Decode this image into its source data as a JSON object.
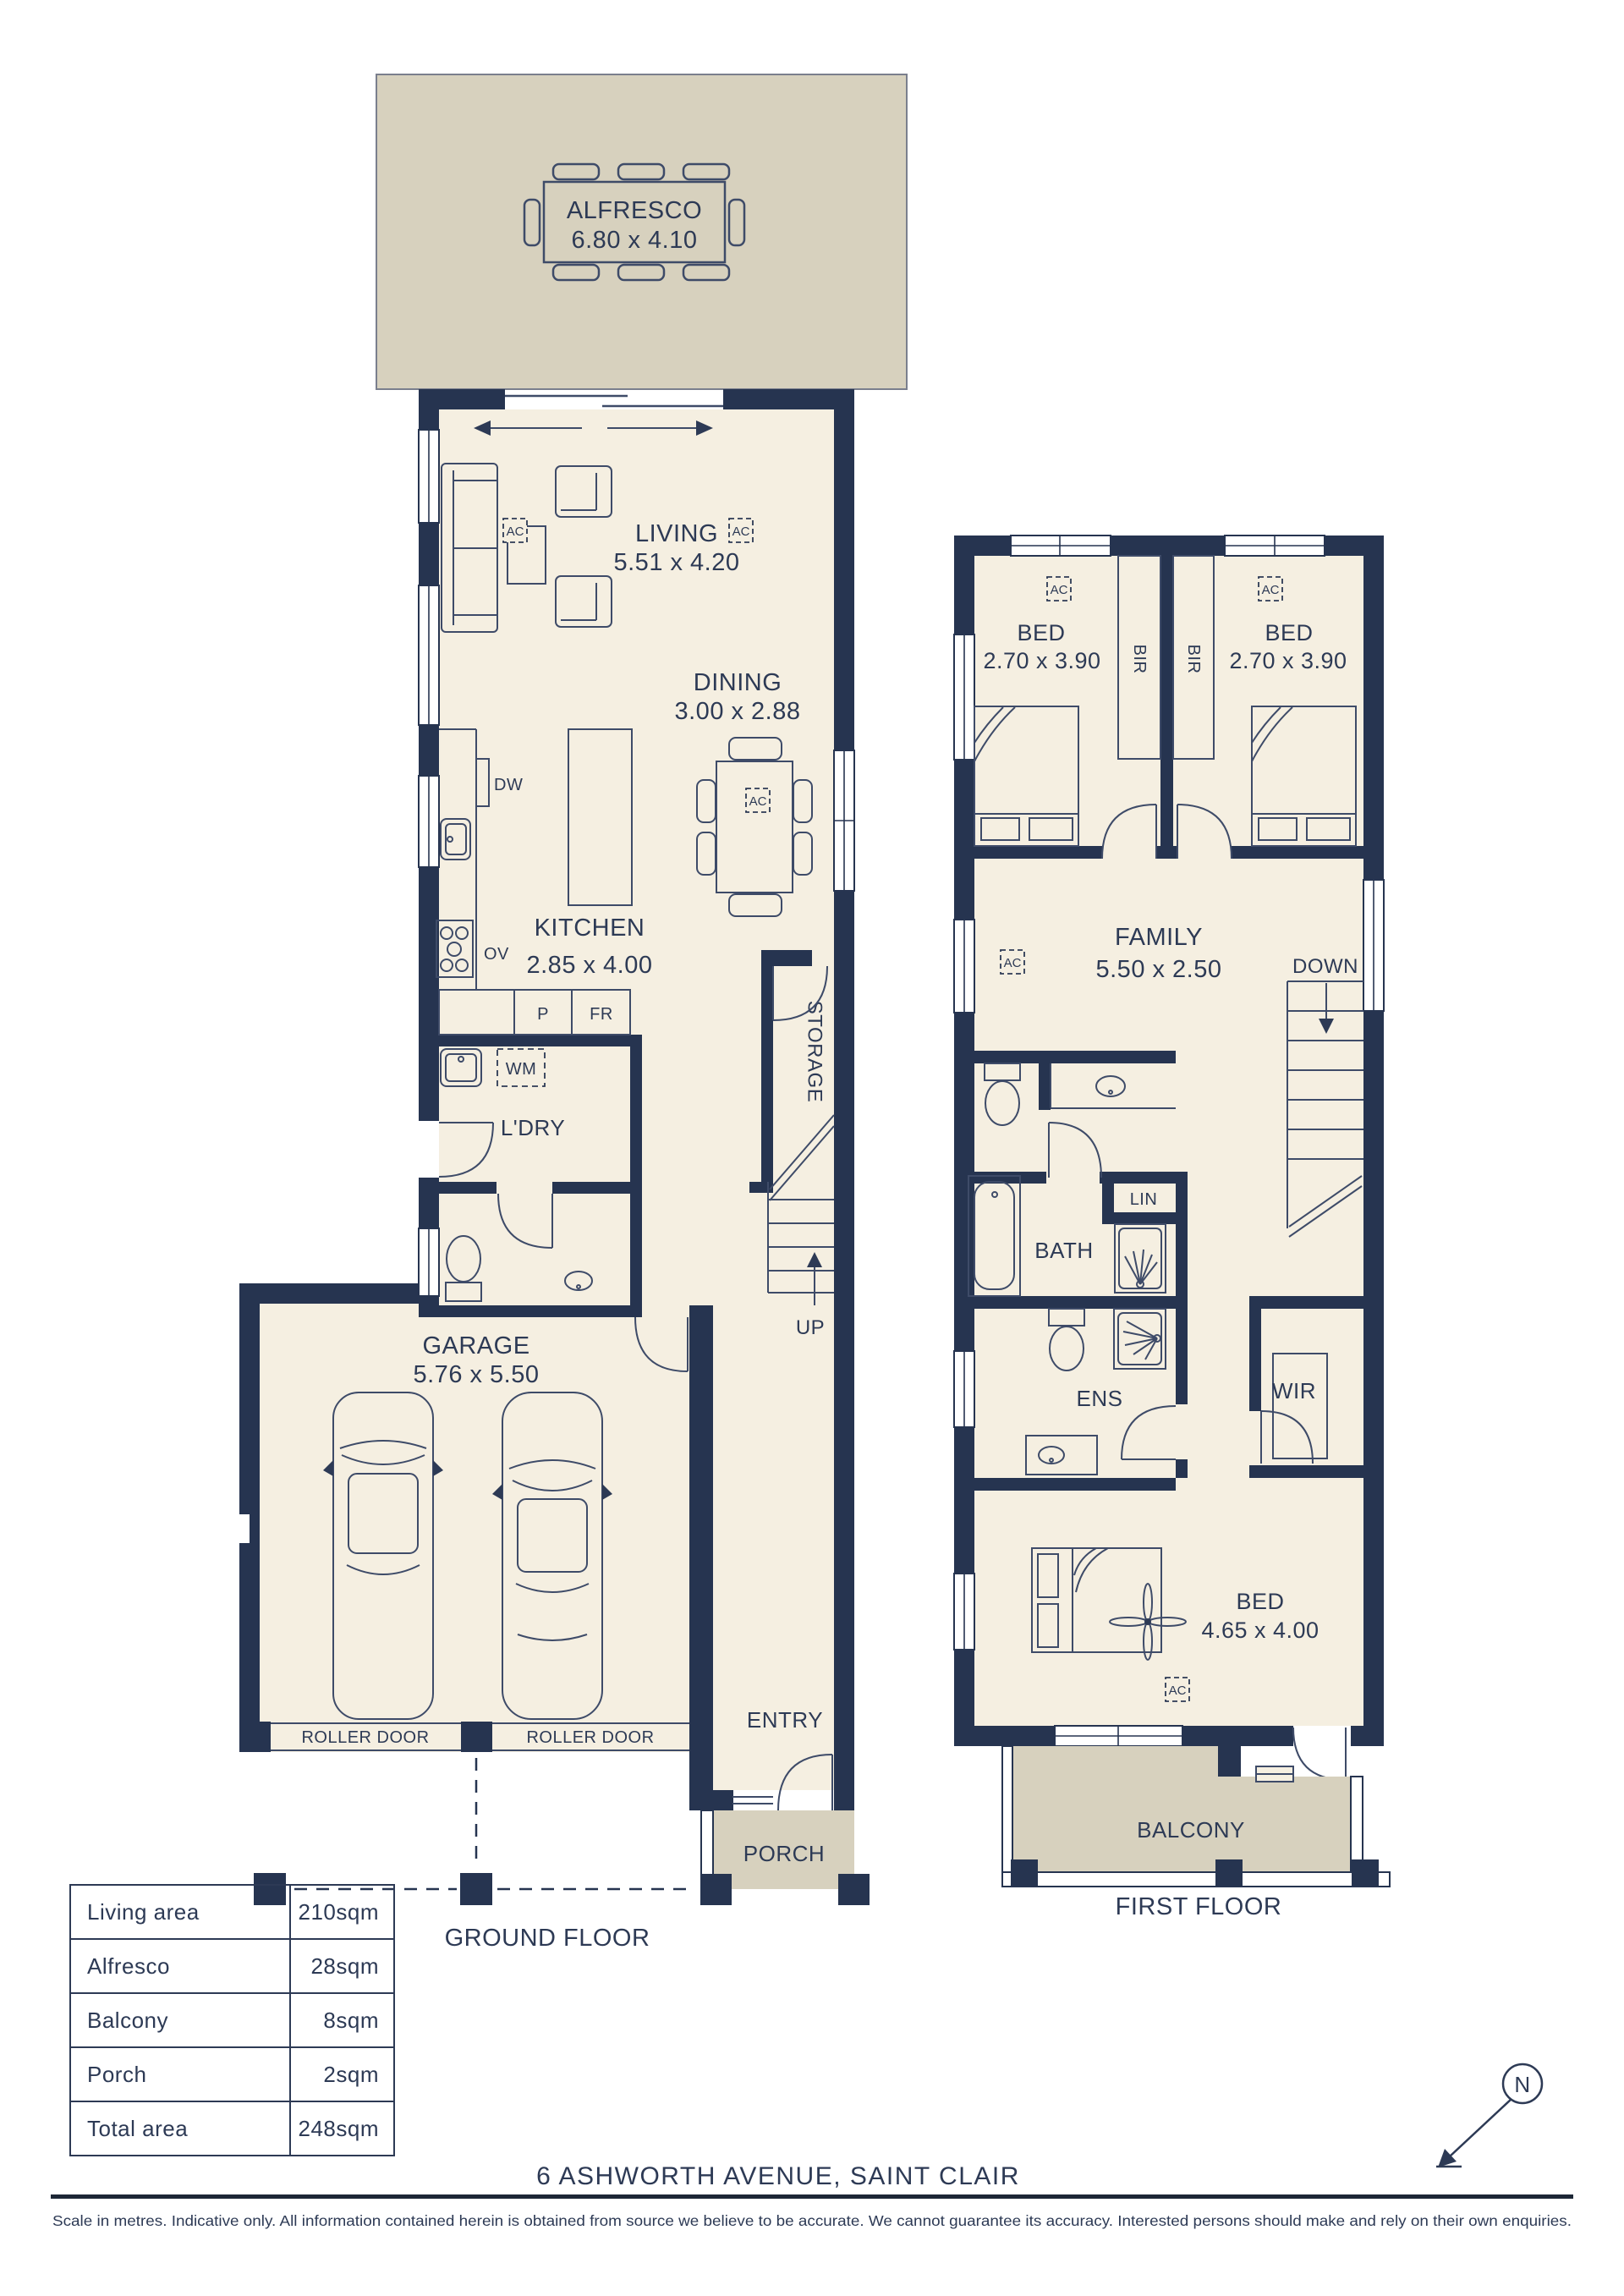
{
  "colors": {
    "wall": "#263450",
    "floor": "#f5efe1",
    "outdoor": "#d7d1be",
    "line": "#3e4b68",
    "text": "#2d3a55",
    "rule": "#1d2736"
  },
  "ground_floor": {
    "caption": "GROUND FLOOR",
    "rooms": {
      "alfresco": {
        "name": "ALFRESCO",
        "dims": "6.80 x 4.10"
      },
      "living": {
        "name": "LIVING",
        "dims": "5.51 x 4.20"
      },
      "dining": {
        "name": "DINING",
        "dims": "3.00 x 2.88"
      },
      "kitchen": {
        "name": "KITCHEN",
        "dims": "2.85 x 4.00"
      },
      "laundry": {
        "name": "L'DRY"
      },
      "storage": {
        "name": "STORAGE"
      },
      "garage": {
        "name": "GARAGE",
        "dims": "5.76 x 5.50"
      },
      "entry": {
        "name": "ENTRY"
      },
      "porch": {
        "name": "PORCH"
      }
    },
    "labels": {
      "dishwasher": "DW",
      "oven": "OV",
      "pantry": "P",
      "fridge": "FR",
      "washing_machine": "WM",
      "roller_door": "ROLLER DOOR",
      "up": "UP",
      "ac": "AC"
    }
  },
  "first_floor": {
    "caption": "FIRST FLOOR",
    "rooms": {
      "bed1": {
        "name": "BED",
        "dims": "2.70 x 3.90"
      },
      "bed2": {
        "name": "BED",
        "dims": "2.70 x 3.90"
      },
      "family": {
        "name": "FAMILY",
        "dims": "5.50 x 2.50"
      },
      "bath": {
        "name": "BATH"
      },
      "linen": {
        "name": "LIN"
      },
      "ensuite": {
        "name": "ENS"
      },
      "wir": {
        "name": "WIR"
      },
      "master_bed": {
        "name": "BED",
        "dims": "4.65 x 4.00"
      },
      "balcony": {
        "name": "BALCONY"
      }
    },
    "labels": {
      "bir": "BIR",
      "down": "DOWN",
      "ac": "AC"
    }
  },
  "area_table": {
    "rows": [
      {
        "label": "Living area",
        "value": "210sqm"
      },
      {
        "label": "Alfresco",
        "value": "28sqm"
      },
      {
        "label": "Balcony",
        "value": "8sqm"
      },
      {
        "label": "Porch",
        "value": "2sqm"
      },
      {
        "label": "Total area",
        "value": "248sqm"
      }
    ]
  },
  "footer": {
    "address": "6 ASHWORTH AVENUE, SAINT CLAIR",
    "disclaimer": "Scale in metres. Indicative only. All information contained herein is obtained from source we believe to be accurate. We cannot guarantee its accuracy. Interested persons should make and rely on their own enquiries."
  },
  "compass": {
    "north": "N"
  }
}
